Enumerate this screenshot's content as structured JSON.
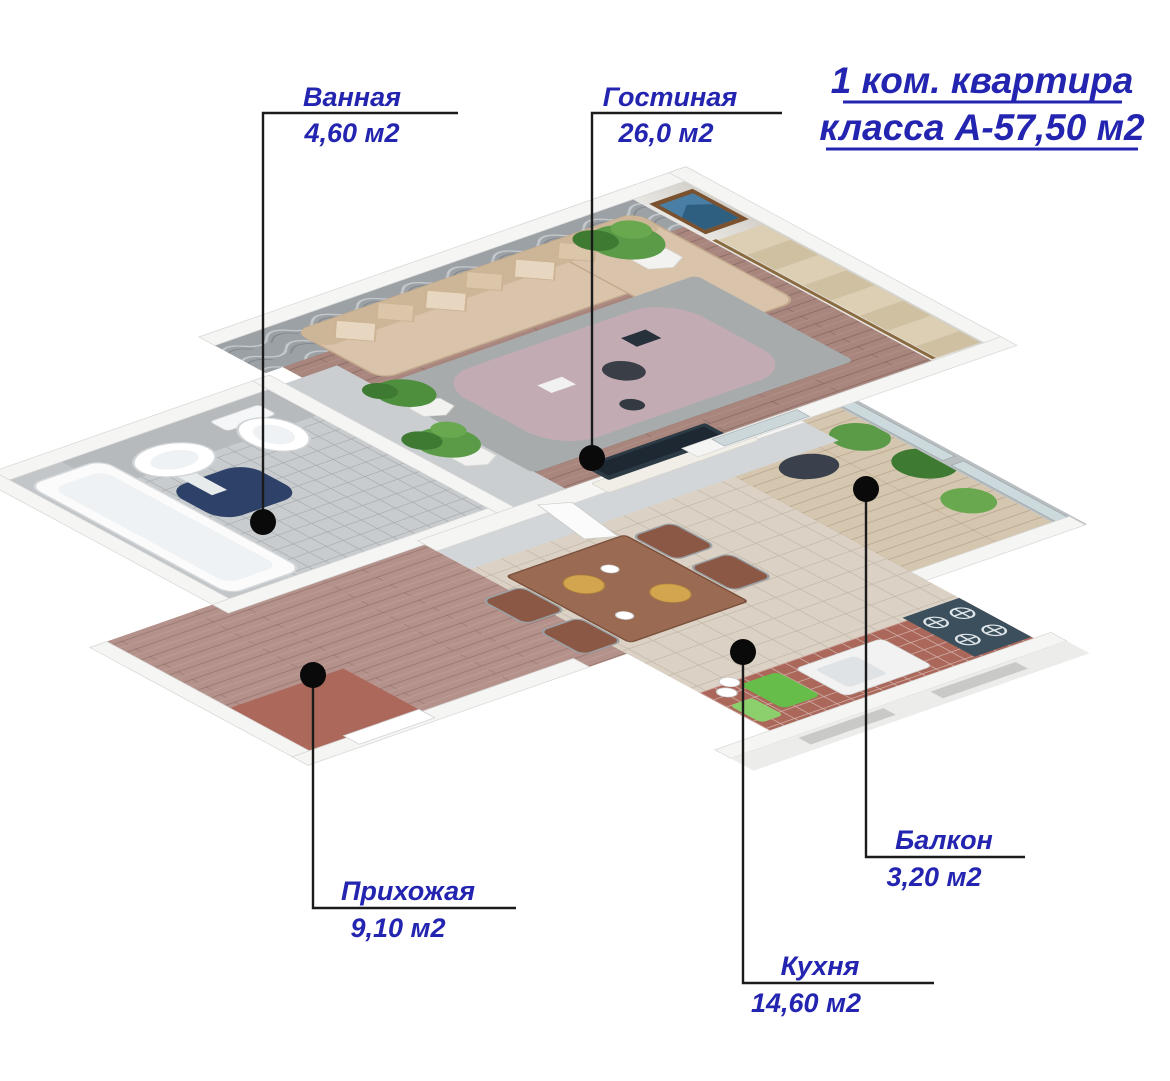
{
  "title": {
    "line1": "1 ком. квартира",
    "line2": "класса А-57,50 м2"
  },
  "rooms": [
    {
      "id": "bathroom",
      "name": "Ванная",
      "area": "4,60 м2"
    },
    {
      "id": "living",
      "name": "Гостиная",
      "area": "26,0 м2"
    },
    {
      "id": "hallway",
      "name": "Прихожая",
      "area": "9,10 м2"
    },
    {
      "id": "kitchen",
      "name": "Кухня",
      "area": "14,60 м2"
    },
    {
      "id": "balcony",
      "name": "Балкон",
      "area": "3,20 м2"
    }
  ],
  "colors": {
    "label_blue": "#2324b0",
    "leader_line": "#1b1b1b",
    "marker_dot": "#0a0a0a",
    "living_floor_wood": "#a8857d",
    "hall_floor_wood": "#b4928b",
    "kitchen_floor_tile": "#dbd2c5",
    "bath_floor_tile": "#c9cccf",
    "accent_wall_panel": "#9ba1a5",
    "sofa_beige": "#d9c3ab",
    "rug_gray": "#a7abac",
    "rug_center_mauve": "#c3abb4",
    "entry_rug_terracotta": "#ad685c",
    "counter_brick": "#aa675a",
    "curtain_beige": "#dccfb4",
    "plant_green": "#5b9b48",
    "navy_bath_mat": "#2e4168"
  }
}
